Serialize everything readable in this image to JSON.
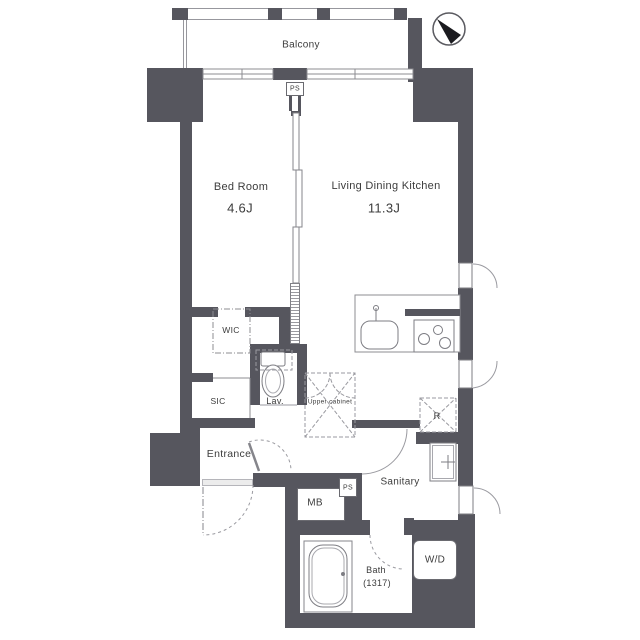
{
  "colors": {
    "wall": "#56565e",
    "line": "#8c8c92",
    "text": "#3c3c3c"
  },
  "compass": {
    "icon": "north-arrow"
  },
  "rooms": {
    "balcony": {
      "label": "Balcony"
    },
    "bedroom": {
      "label": "Bed Room",
      "size": "4.6J"
    },
    "ldk": {
      "label": "Living Dining Kitchen",
      "size": "11.3J"
    },
    "wic": {
      "label": "WIC"
    },
    "sic": {
      "label": "SIC"
    },
    "lav": {
      "label": "Lav."
    },
    "upper_cabinet": {
      "label": "Upper cabinet"
    },
    "entrance": {
      "label": "Entrance"
    },
    "sanitary": {
      "label": "Sanitary"
    },
    "bath": {
      "label": "Bath",
      "size": "(1317)"
    },
    "mb": {
      "label": "MB"
    },
    "ps_top": {
      "label": "PS"
    },
    "ps_bottom": {
      "label": "PS"
    },
    "wd": {
      "label": "W/D"
    },
    "refrigerator": {
      "label": "R"
    }
  }
}
